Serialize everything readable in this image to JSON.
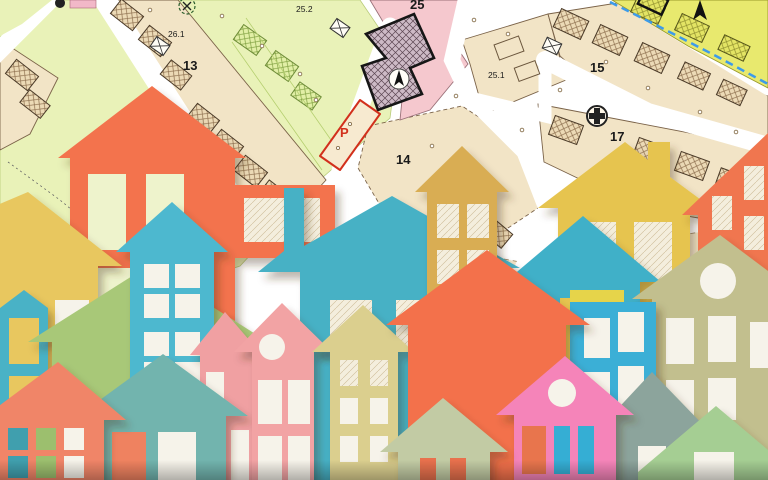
{
  "map": {
    "labels": {
      "block_25_2": "25.2",
      "block_26_1": "26.1",
      "block_13": "13",
      "block_25": "25",
      "block_25_1": "25.1",
      "block_15": "15",
      "block_17": "17",
      "block_14": "14",
      "parking": "P"
    },
    "colors": {
      "road": "#ffffff",
      "parcel": "#f2e4c6",
      "parcel_outline": "#7a6248",
      "green_zone": "#e9f2b8",
      "pink_zone": "#f5c8ce",
      "yellow_zone": "#e8e96e",
      "special_building_fill": "#cdbac6",
      "special_building_stroke": "#161616",
      "parking_outline": "#d2301c",
      "dashed_boundary_blue": "#3d9be9"
    },
    "symbols": [
      "crossed-circle-icon",
      "north-arrow-icon",
      "plus-circle-icon",
      "building-x-icon"
    ]
  },
  "houses": [
    {
      "name": "orange-house-top-left",
      "color": "#f3734d"
    },
    {
      "name": "yellow-house-left",
      "color": "#e8c75e"
    },
    {
      "name": "teal-house-far-left",
      "color": "#4ab2c6"
    },
    {
      "name": "lime-house-left",
      "color": "#a8c878"
    },
    {
      "name": "teal-house-chimney",
      "color": "#46b1c5"
    },
    {
      "name": "mustard-tall-house",
      "color": "#d9ad52"
    },
    {
      "name": "yellow-house-chimney-right",
      "color": "#e6c44f"
    },
    {
      "name": "teal-house-center-right",
      "color": "#3fb0c8"
    },
    {
      "name": "orange-tall-house-right",
      "color": "#f0764f"
    },
    {
      "name": "olive-house-circle-window",
      "color": "#c2bf8e"
    },
    {
      "name": "yellow-sliver",
      "color": "#e6d44a"
    },
    {
      "name": "blue-tall-house-right",
      "color": "#3aafd6"
    },
    {
      "name": "blue-house-four-pane",
      "color": "#4db8cf"
    },
    {
      "name": "pink-house-left",
      "color": "#f0a0a2"
    },
    {
      "name": "muted-teal-house",
      "color": "#72b4ae"
    },
    {
      "name": "coral-house-bottom-left",
      "color": "#f08568"
    },
    {
      "name": "pink-house-circle",
      "color": "#f2a3a4"
    },
    {
      "name": "khaki-ladder-house",
      "color": "#dbcf8e"
    },
    {
      "name": "coral-house-center",
      "color": "#f3714b"
    },
    {
      "name": "gray-green-house",
      "color": "#8ca49c"
    },
    {
      "name": "bright-pink-house",
      "color": "#f584b9"
    },
    {
      "name": "sage-house",
      "color": "#c2cba4"
    },
    {
      "name": "light-green-house",
      "color": "#a5ce93"
    }
  ]
}
